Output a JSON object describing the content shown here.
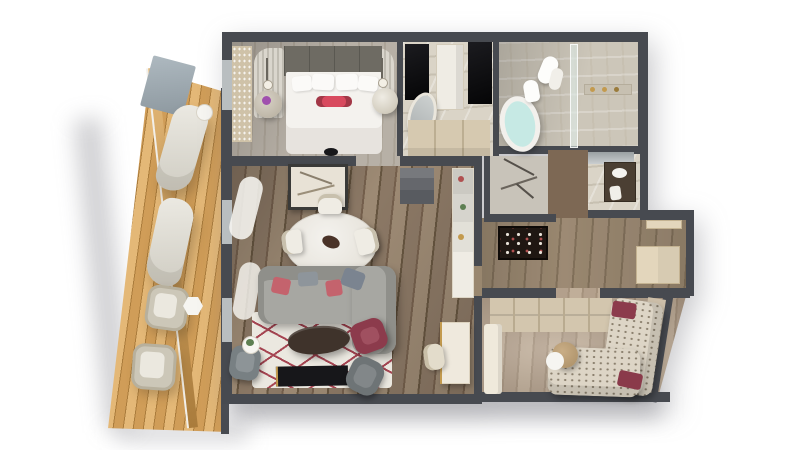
{
  "scene": {
    "title": "Isometric 3D floor plan render of a one-bedroom suite with wraparound balcony",
    "rooms": [
      {
        "name": "Balcony",
        "furniture": [
          "curved sun lounger",
          "curved sun lounger",
          "round side table",
          "wicker armchair",
          "wicker armchair",
          "hexagonal side table",
          "glass privacy screen",
          "timber deck rail"
        ]
      },
      {
        "name": "Master Bedroom",
        "furniture": [
          "king bed with white linens",
          "crimson bolster cushion",
          "upholstered headboard",
          "fluted wing panel",
          "fluted wing panel",
          "pendant lamp",
          "pendant lamp",
          "round nightstand with purple flowers",
          "round nightstand",
          "shimmer wardrobe front",
          "black ottoman"
        ]
      },
      {
        "name": "Dressing Area",
        "furniture": [
          "dark mirror panel",
          "dark mirror panel",
          "oval standing mirror",
          "tall wardrobe cabinet",
          "low dresser"
        ]
      },
      {
        "name": "Bathroom",
        "furniture": [
          "freestanding bathtub",
          "toilet",
          "hanging towels",
          "glass shower screen",
          "marble walk-in shower",
          "toiletry niche"
        ]
      },
      {
        "name": "Powder Room",
        "furniture": [
          "etched glass art screen"
        ]
      },
      {
        "name": "Vanity WC",
        "furniture": [
          "washbasin counter",
          "wall mirror",
          "hand towel"
        ]
      },
      {
        "name": "Entry Hall",
        "furniture": [
          "floral wall artwork",
          "entrance door",
          "closet doors"
        ]
      },
      {
        "name": "Living & Dining Room",
        "furniture": [
          "round marble dining table",
          "dining chair",
          "dining chair",
          "dining chair",
          "dining chair",
          "abstract framed art",
          "sheer window curtains",
          "dark display shelf",
          "white display column",
          "grey fabric sofa with chaise",
          "coral cushions",
          "slate cushions",
          "area rug with red line pattern",
          "oval dark coffee table",
          "burgundy accent chair",
          "grey lounge chair",
          "grey lounge chair",
          "white side table with plant",
          "black media console",
          "writing desk",
          "desk chair"
        ]
      },
      {
        "name": "Second Bedroom Lounge",
        "furniture": [
          "closet shelving wall",
          "patterned sectional sofa",
          "burgundy cushion",
          "burgundy cushion",
          "round timber side table",
          "white bench console"
        ]
      }
    ]
  },
  "palette": {
    "bg": "#ffffff",
    "wall": "#474a50",
    "wall-face": "#5d6066",
    "wood": "#8b7865",
    "wood-dark": "#745f4c",
    "wood-light": "#9d8a74",
    "wood-gap": "#65543f",
    "hall-wood": "#99876f",
    "hall-gap": "#81705a",
    "bed-floor": "#b7b0a6",
    "bed-floor-dark": "#aba397",
    "bed2-floor": "#b3a08c",
    "bed2-dark": "#a5927d",
    "bed2-light": "#c0ae99",
    "balcony": "#d09d58",
    "balcony-dark": "#aa7c3c",
    "balcony-light": "#e4b877",
    "marble": "#dad4c7",
    "marble-shadow": "#c7c0b1",
    "tilec": "#ccc6b9",
    "cream": "#efece4",
    "beige": "#d6c9b0",
    "beige-dark": "#bcae92",
    "white": "#f6f5f1",
    "headboard": "#6e6b63",
    "sofa": "#a7a7a2",
    "sofa-dark": "#8f8f8a",
    "slate": "#7b8490",
    "coral": "#c4636d",
    "crimson": "#d84a5e",
    "burgundy": "#8c3b4c",
    "water": "#c6e9e4",
    "glassc": "rgba(223,236,233,0.6)",
    "dark": "#17171a",
    "rug": "#ebe8e0",
    "rug-red": "#a64552",
    "graychair": "#788083",
    "graychair2": "#6e7476",
    "wood-wall": "#7d6854",
    "door": "#e3d6bc",
    "mirror": "#b9bec0",
    "gold": "#c39a4e",
    "plant": "#5d7f52",
    "purple": "#a050ae",
    "shadow": "rgba(115,115,122,0.34)"
  }
}
